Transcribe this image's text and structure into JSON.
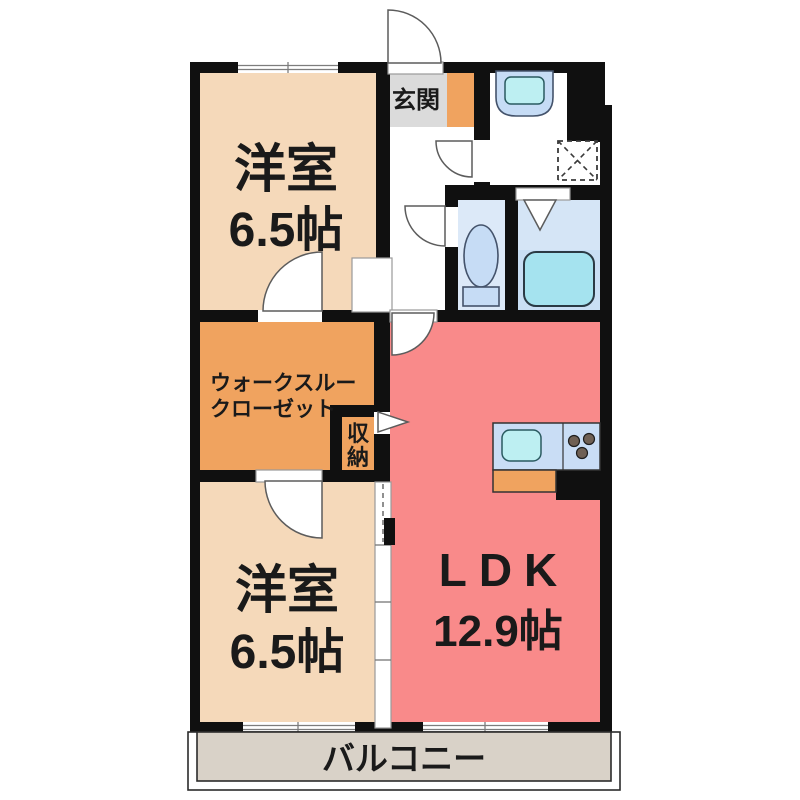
{
  "floor_plan": {
    "rooms": {
      "bedroom_top": {
        "name": "洋室",
        "size": "6.5帖"
      },
      "bedroom_bottom": {
        "name": "洋室",
        "size": "6.5帖"
      },
      "ldk": {
        "name": "LDK",
        "size": "12.9帖"
      },
      "entrance": {
        "label": "玄関"
      },
      "walkthrough_closet": {
        "line1": "ウォークスルー",
        "line2": "クローゼット"
      },
      "storage": {
        "char1": "収",
        "char2": "納"
      },
      "balcony": {
        "label": "バルコニー"
      }
    },
    "fixtures": {
      "toilet": "toilet-icon",
      "bathtub": "bathtub-icon",
      "washbasin": "washbasin-icon",
      "kitchen_sink": "kitchen-sink-icon",
      "stove_burners": "stove-burners-icon",
      "washer_space": "washing-machine-space-icon"
    },
    "colors": {
      "wall": "#101010",
      "room_peach": "#F5D9BA",
      "closet_orange": "#F0A35F",
      "ldk_salmon": "#F98A8A",
      "genkan_gray": "#DBDBDB",
      "water_blue": "#DCE9F8",
      "bath_blue": "#D5E5F6",
      "bath_lower": "#C9DFF4",
      "tub_cyan": "#A5E3EF",
      "fixture_blue": "#C6DCF5",
      "counter_blue": "#C9DDF5",
      "sink_cyan": "#BDEFF2",
      "burner_brown": "#6F6054",
      "balcony_beige": "#D9D2C8",
      "label_black": "#1A1A1A"
    }
  }
}
